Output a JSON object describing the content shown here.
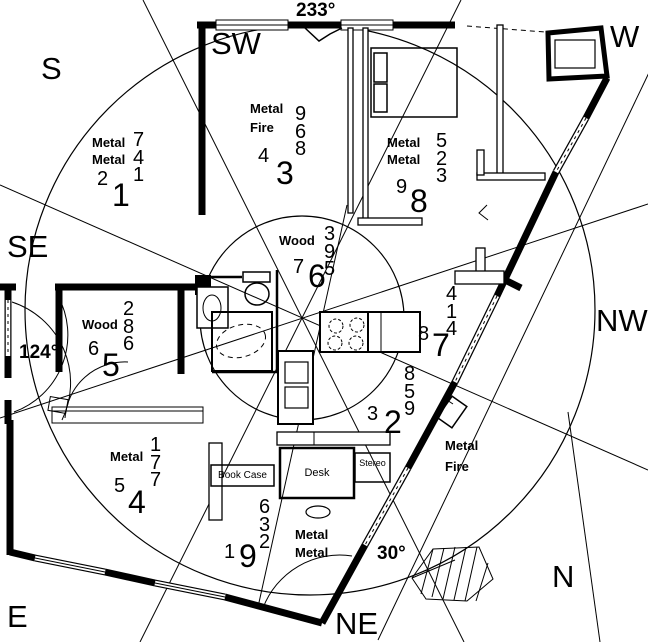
{
  "compass_labels": {
    "s": "S",
    "sw": "SW",
    "w": "W",
    "se": "SE",
    "nw": "NW",
    "e": "E",
    "ne": "NE",
    "n": "N"
  },
  "degree_labels": {
    "facing": "233°",
    "entry": "124°",
    "ne_angle": "30°"
  },
  "palaces": [
    {
      "name": "top-left",
      "elements": [
        "Metal",
        "Metal"
      ],
      "star_column": [
        "7",
        "4",
        "1"
      ],
      "star_medium": "2",
      "star_big": "1"
    },
    {
      "name": "top-center",
      "elements": [
        "Metal",
        "Fire"
      ],
      "star_column": [
        "9",
        "6",
        "8"
      ],
      "star_medium": "4",
      "star_big": "3"
    },
    {
      "name": "top-right",
      "elements": [
        "Metal",
        "Metal"
      ],
      "star_column": [
        "5",
        "2",
        "3"
      ],
      "star_medium": "9",
      "star_big": "8"
    },
    {
      "name": "center",
      "elements": [
        "Wood"
      ],
      "star_column": [
        "3",
        "9",
        "5"
      ],
      "star_medium": "7",
      "star_big": "6"
    },
    {
      "name": "left",
      "elements": [
        "Wood"
      ],
      "star_column": [
        "2",
        "8",
        "6"
      ],
      "star_medium": "6",
      "star_big": "5"
    },
    {
      "name": "right",
      "elements": [],
      "star_column": [
        "4",
        "1",
        "4"
      ],
      "star_medium": "8",
      "star_big": "7"
    },
    {
      "name": "lower-right",
      "elements": [],
      "star_column": [
        "8",
        "5",
        "9"
      ],
      "star_medium": "3",
      "star_big": "2"
    },
    {
      "name": "bottom-left",
      "elements": [
        "Metal"
      ],
      "star_column": [
        "1",
        "7",
        "7"
      ],
      "star_medium": "5",
      "star_big": "4"
    },
    {
      "name": "bottom-center",
      "elements": [
        "Metal",
        "Metal"
      ],
      "star_column": [
        "6",
        "3",
        "2"
      ],
      "star_medium": "1",
      "star_big": "9"
    },
    {
      "name": "bottom-right",
      "elements": [
        "Metal",
        "Fire"
      ],
      "star_column": [],
      "star_medium": "",
      "star_big": ""
    }
  ],
  "furniture_labels": {
    "book_case": "Book Case",
    "desk": "Desk",
    "stereo": "Stereo"
  },
  "colors": {
    "ink": "#000000",
    "paper": "#ffffff"
  }
}
